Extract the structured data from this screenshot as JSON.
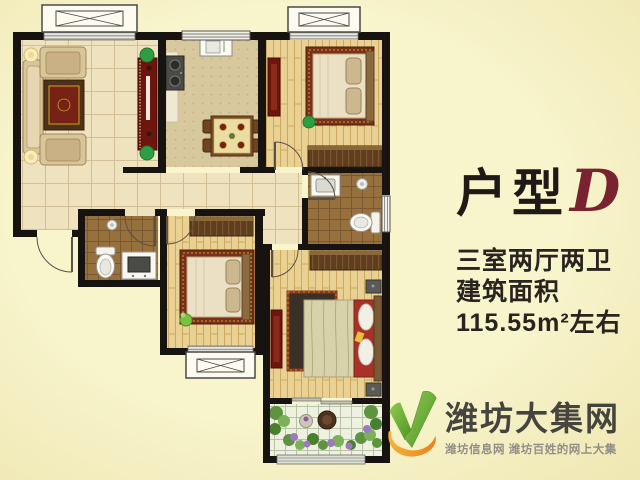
{
  "title": {
    "text": "户型",
    "suffix_letter": "D",
    "letter_color": "#7A2330"
  },
  "specs": {
    "rooms": "三室两厅两卫",
    "area_label": "建筑面积",
    "area_value": "115.55m²左右"
  },
  "watermark": {
    "site_name": "潍坊大集网",
    "tagline": "潍坊信息网 潍坊百姓的网上大集",
    "icon": "checkmark-leaf-logo",
    "logo_green": "#6FB83E",
    "logo_orange": "#F09C1E"
  },
  "colors": {
    "background": "#F6F1C3",
    "wall": "#171310",
    "accent_red_cabinet": "#6E150E",
    "title_text": "#1F1A15",
    "spec_text": "#29241F",
    "logo_text": "#45443E",
    "logo_tagline": "#8F8F87"
  }
}
